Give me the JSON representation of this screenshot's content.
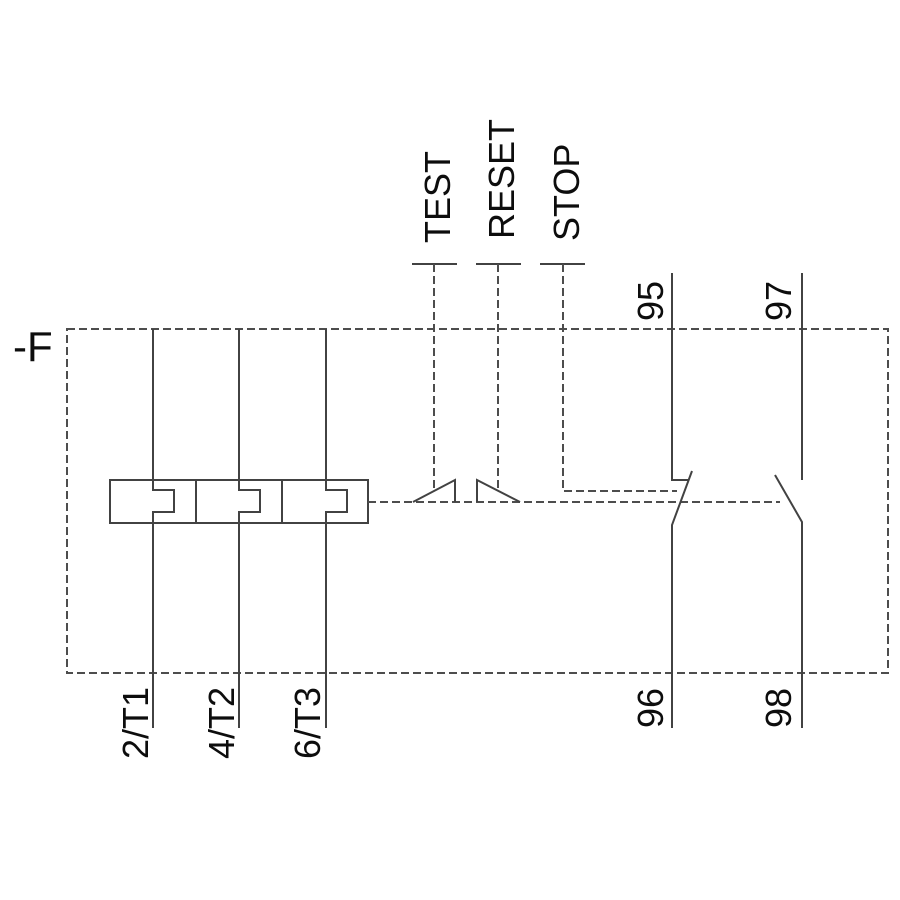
{
  "schematic": {
    "device_tag": "-F",
    "actuators": [
      {
        "label": "TEST"
      },
      {
        "label": "RESET"
      },
      {
        "label": "STOP"
      }
    ],
    "load_terminals": [
      {
        "label": "2/T1"
      },
      {
        "label": "4/T2"
      },
      {
        "label": "6/T3"
      }
    ],
    "auxiliary_contacts": [
      {
        "type": "NC",
        "top_terminal": "95",
        "bottom_terminal": "96"
      },
      {
        "type": "NO",
        "top_terminal": "97",
        "bottom_terminal": "98"
      }
    ],
    "colors": {
      "solid_line": "#424242",
      "dashed_line": "#4d4d4d",
      "text": "#0d0d0d",
      "background": "#ffffff"
    }
  }
}
